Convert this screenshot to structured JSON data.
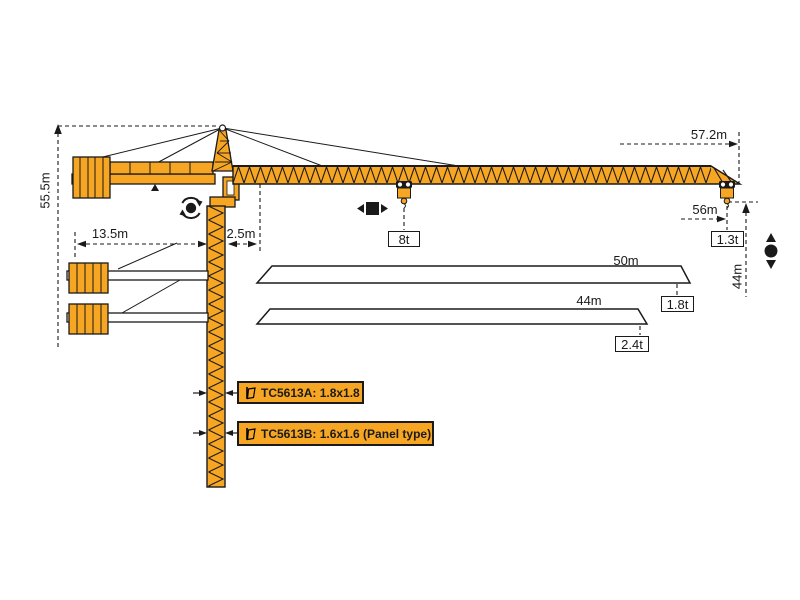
{
  "title": "TC5613 tower crane working range and load diagram",
  "colors": {
    "crane_orange": "#F6A623",
    "outline_black": "#1A1A1A",
    "background": "#FFFFFF"
  },
  "dimension_labels": {
    "tower_height": "55.5m",
    "counter_jib_radius": "13.5m",
    "min_radius": "2.5m",
    "max_jib_radius": "57.2m",
    "max_hook_radius": "56m",
    "hook_height": "44m"
  },
  "load_labels": {
    "mid_jib_load": "8t",
    "tip_load_56m": "1.3t",
    "tip_load_50m": "1.8t",
    "tip_load_44m": "2.4t"
  },
  "jib_options": {
    "option_50m": "50m",
    "option_44m": "44m"
  },
  "mast_section_labels": {
    "variant_a": "TC5613A:  1.8x1.8",
    "variant_b": "TC5613B:  1.6x1.6  (Panel type)"
  },
  "icons": {
    "slewing": "slewing-rotation-icon",
    "trolley_travel": "trolley-travel-icon",
    "hoist": "hoist-up-down-icon",
    "mast_section": "mast-section-icon"
  }
}
